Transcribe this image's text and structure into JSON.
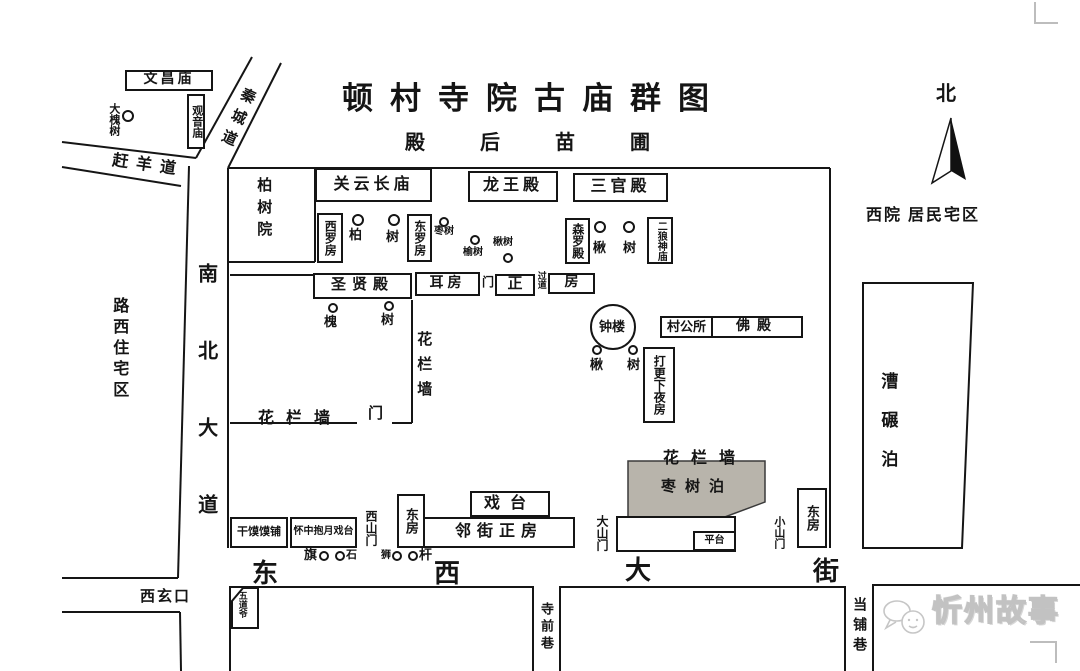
{
  "title": "顿村寺院古庙群图",
  "colors": {
    "ink": "#151515",
    "shade": "#b8b4ab",
    "watermark": "#c2c2c2"
  },
  "compass": {
    "label": "北"
  },
  "areas": {
    "nursery": "殿后苗圃",
    "west_courtyard": "西院 居民宅区",
    "west_residential": "路西住宅区",
    "mill_pool": "漕碾泊",
    "jujube_pool": "枣树泊",
    "flower_wall_top": "花栏墙",
    "flower_wall_side": "花栏墙",
    "flower_wall_inner": "花栏墙"
  },
  "roads": {
    "qincheng": "秦城道",
    "ganyang": "赶羊道",
    "nanbei": "南北大道",
    "street_chars": [
      "东",
      "西",
      "大",
      "街"
    ],
    "xixuankou": "西玄口",
    "temple_front_lane": "寺前巷",
    "pawnshop_lane": "当铺巷"
  },
  "buildings": {
    "wenchang": "文昌庙",
    "guanyin": "观音庙",
    "cypress_yard": "柏树院",
    "guanyu": "关云长庙",
    "dragon_king": "龙王殿",
    "three_officials": "三官殿",
    "west_luo": "西罗房",
    "east_luo": "东罗房",
    "senluo": "森罗殿",
    "erlang": "二狼神庙",
    "sage_hall": "圣贤殿",
    "ear_room": "耳房",
    "gate_small": "门",
    "main_front": "正",
    "passage": "过道",
    "main_back": "房",
    "bell_tower": "钟楼",
    "village_office": "村公所",
    "buddha_hall": "佛殿",
    "night_watch": "打更下夜房",
    "inner_gate": "门",
    "stage": "戏台",
    "east_room_west": "东房",
    "street_front": "邻街正房",
    "bun_shop": "干馍馍铺",
    "moon_stage": "怀中抱月戏台",
    "west_gate": "西山门",
    "great_gate": "大山门",
    "platform": "平台",
    "small_gate": "小山门",
    "east_room_east": "东房",
    "wudao": "五道爷"
  },
  "trees": [
    "大槐树",
    "柏",
    "树",
    "枣树",
    "榆树",
    "楸树",
    "楸",
    "树",
    "槐",
    "树",
    "楸",
    "树"
  ],
  "markers": {
    "flag": "旗",
    "stone": "石",
    "lion": "狮",
    "pole": "杆"
  },
  "watermark": "忻州故事"
}
